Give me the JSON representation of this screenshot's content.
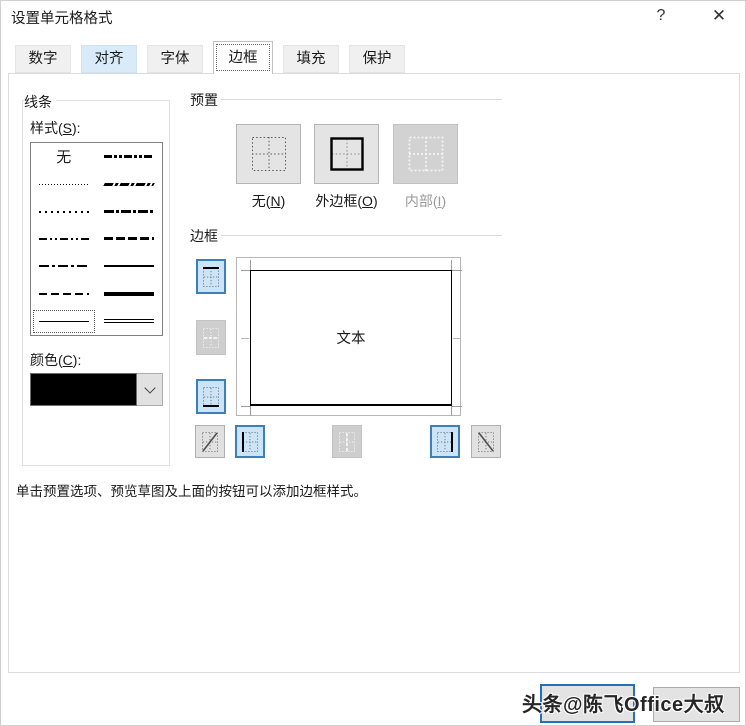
{
  "window": {
    "title": "设置单元格格式",
    "help_glyph": "?",
    "close_glyph": "✕"
  },
  "tabs": [
    {
      "name": "number",
      "label": "数字",
      "state": "normal"
    },
    {
      "name": "alignment",
      "label": "对齐",
      "state": "hover"
    },
    {
      "name": "font",
      "label": "字体",
      "state": "normal"
    },
    {
      "name": "border",
      "label": "边框",
      "state": "selected"
    },
    {
      "name": "fill",
      "label": "填充",
      "state": "normal"
    },
    {
      "name": "protection",
      "label": "保护",
      "state": "normal"
    }
  ],
  "line_group": {
    "title": "线条",
    "style_label": {
      "pre": "样式(",
      "key": "S",
      "post": "):"
    },
    "none_label": "无",
    "styles": [
      {
        "pattern": "none",
        "selected": false
      },
      {
        "pattern": "hairline",
        "selected": false
      },
      {
        "pattern": "dotted",
        "selected": false
      },
      {
        "pattern": "dash-dot-dot",
        "selected": false
      },
      {
        "pattern": "dash-dot",
        "selected": false
      },
      {
        "pattern": "dashed",
        "selected": false
      },
      {
        "pattern": "thin-solid",
        "selected": true
      },
      {
        "pattern": "medium-dash-dot-dot",
        "selected": false
      },
      {
        "pattern": "slant-dash-dot",
        "selected": false
      },
      {
        "pattern": "medium-dash-dot",
        "selected": false
      },
      {
        "pattern": "medium-dashed",
        "selected": false
      },
      {
        "pattern": "medium-solid",
        "selected": false
      },
      {
        "pattern": "thick-solid",
        "selected": false
      },
      {
        "pattern": "double",
        "selected": false
      }
    ],
    "color_label": {
      "pre": "颜色(",
      "key": "C",
      "post": "):"
    },
    "color_value": "#000000"
  },
  "presets_group": {
    "title": "预置",
    "buttons": [
      {
        "name": "none",
        "pre": "无(",
        "key": "N",
        "post": ")",
        "enabled": true
      },
      {
        "name": "outline",
        "pre": "外边框(",
        "key": "O",
        "post": ")",
        "enabled": true
      },
      {
        "name": "inside",
        "pre": "内部(",
        "key": "I",
        "post": ")",
        "enabled": false
      }
    ]
  },
  "border_group": {
    "title": "边框",
    "preview_text": "文本",
    "buttons": [
      {
        "name": "top-border",
        "state": "active"
      },
      {
        "name": "horizontal-middle-border",
        "state": "disabled"
      },
      {
        "name": "bottom-border",
        "state": "active"
      },
      {
        "name": "diagonal-up-border",
        "state": "normal"
      },
      {
        "name": "left-border",
        "state": "active"
      },
      {
        "name": "vertical-middle-border",
        "state": "disabled"
      },
      {
        "name": "right-border",
        "state": "active"
      },
      {
        "name": "diagonal-down-border",
        "state": "normal"
      }
    ]
  },
  "hint": "单击预置选项、预览草图及上面的按钮可以添加边框样式。",
  "footer": {
    "watermark": "头条@陈飞Office大叔"
  },
  "colors": {
    "accent_blue": "#3c7fb9",
    "toggle_bg": "#cce4f7",
    "tab_hover": "#d9ebf9",
    "selected_line_color": "#000000"
  }
}
